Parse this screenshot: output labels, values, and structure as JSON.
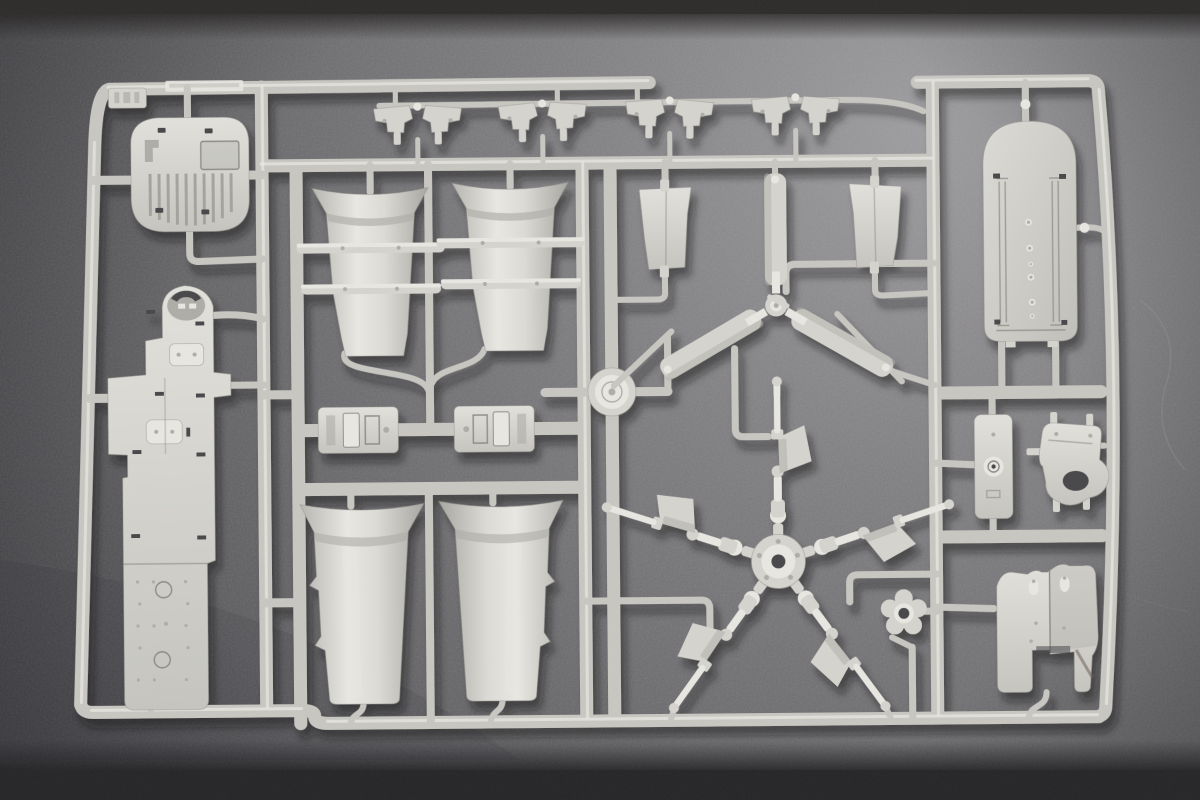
{
  "scene": {
    "type": "photograph",
    "subject": "Injection-molded plastic model kit sprue (runner frame) with unassembled helicopter-kit parts",
    "setting": "light gray styrene sprue lying flat on a dark warm-gray slate surface, lit from the upper right",
    "description": "Photograph of a light gray plastic model-kit sprue lying on a dark gray stone surface. The rectangular runner frame holds many unassembled parts: a ribbed deck panel and a long cabin-floor panel on the left, four flared funnel-shaped cowling halves in the center, a row of small detail parts along the top, two tapered side panels and a three-blade tail rotor in the upper center, a large five-armed main rotor head in the lower center, and on the right a rounded roof panel, an equipment plate, a hook bracket, a small star-shaped hub and a pair of curved engine cowlings.",
    "sprue_color_name": "light gray styrene",
    "surface_color_name": "dark warm gray slate",
    "parts_inventory": [
      {
        "name": "ribbed deck panel",
        "count": 1,
        "location": "top left"
      },
      {
        "name": "cabin floor long panel",
        "count": 1,
        "location": "left"
      },
      {
        "name": "flared funnel cowling half",
        "count": 4,
        "location": "center, two upper and two lower"
      },
      {
        "name": "small detail part",
        "count": 8,
        "location": "top center strip"
      },
      {
        "name": "tapered side panel",
        "count": 2,
        "location": "upper center"
      },
      {
        "name": "tail rotor blade",
        "count": 3,
        "location": "upper center, molded as three-blade assembly"
      },
      {
        "name": "five-arm main rotor head with blade-grip pennants",
        "count": 1,
        "location": "lower center"
      },
      {
        "name": "engine deck plate",
        "count": 2,
        "location": "mid center"
      },
      {
        "name": "rounded roof panel with rivet line",
        "count": 1,
        "location": "upper right"
      },
      {
        "name": "equipment plate with round boss",
        "count": 1,
        "location": "mid right"
      },
      {
        "name": "hook bracket",
        "count": 1,
        "location": "mid right"
      },
      {
        "name": "curved engine cowling half",
        "count": 2,
        "location": "lower right"
      },
      {
        "name": "small star hub",
        "count": 1,
        "location": "center right"
      },
      {
        "name": "circular runner boss",
        "count": 1,
        "location": "center of sprue"
      }
    ],
    "palette": {
      "bg_light": "#98979a",
      "bg_mid": "#6b6a6d",
      "bg_dark": "#434346",
      "band_top": "#2e2c2b",
      "band_bottom": "#262629",
      "rail": "#c7c6c0",
      "rail_hl": "#ecebe5",
      "rail_dk": "#8f8e88",
      "part": "#d4d3cd",
      "part_light": "#e7e6e1",
      "part_dark": "#adaca6",
      "detail": "#8a8983",
      "hole": "#46464a"
    }
  }
}
